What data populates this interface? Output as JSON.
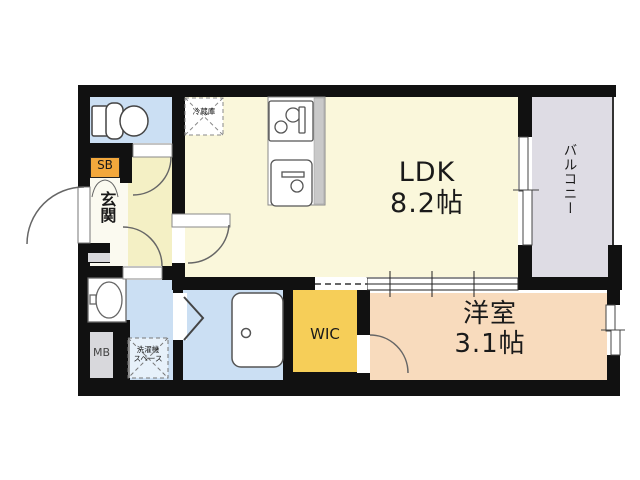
{
  "title": "1K apartment floor plan",
  "rooms": {
    "ldk": {
      "name": "LDK",
      "size": "8.2帖"
    },
    "western_room": {
      "name": "洋室",
      "size": "3.1帖"
    },
    "balcony": {
      "label": "バルコニー"
    },
    "entrance": {
      "label": "玄関"
    },
    "wic": {
      "label": "WIC"
    },
    "shoe_box": {
      "label": "SB"
    },
    "meter_box": {
      "label": "MB"
    },
    "refrigerator": {
      "label": "冷蔵庫"
    },
    "washer_space": {
      "line1": "洗濯機",
      "line2": "スペース"
    }
  },
  "colors": {
    "wall": "#111111",
    "ldk_floor": "#FAF7DB",
    "hall_floor": "#F4F0C5",
    "entrance_floor": "#FBFAF0",
    "wet_area": "#CBDFF3",
    "shoe_box": "#F3A83C",
    "wic": "#F6CE58",
    "western_room": "#F8DBBD",
    "balcony": "#DEDCE4",
    "meter_box": "#D8D8DC"
  }
}
